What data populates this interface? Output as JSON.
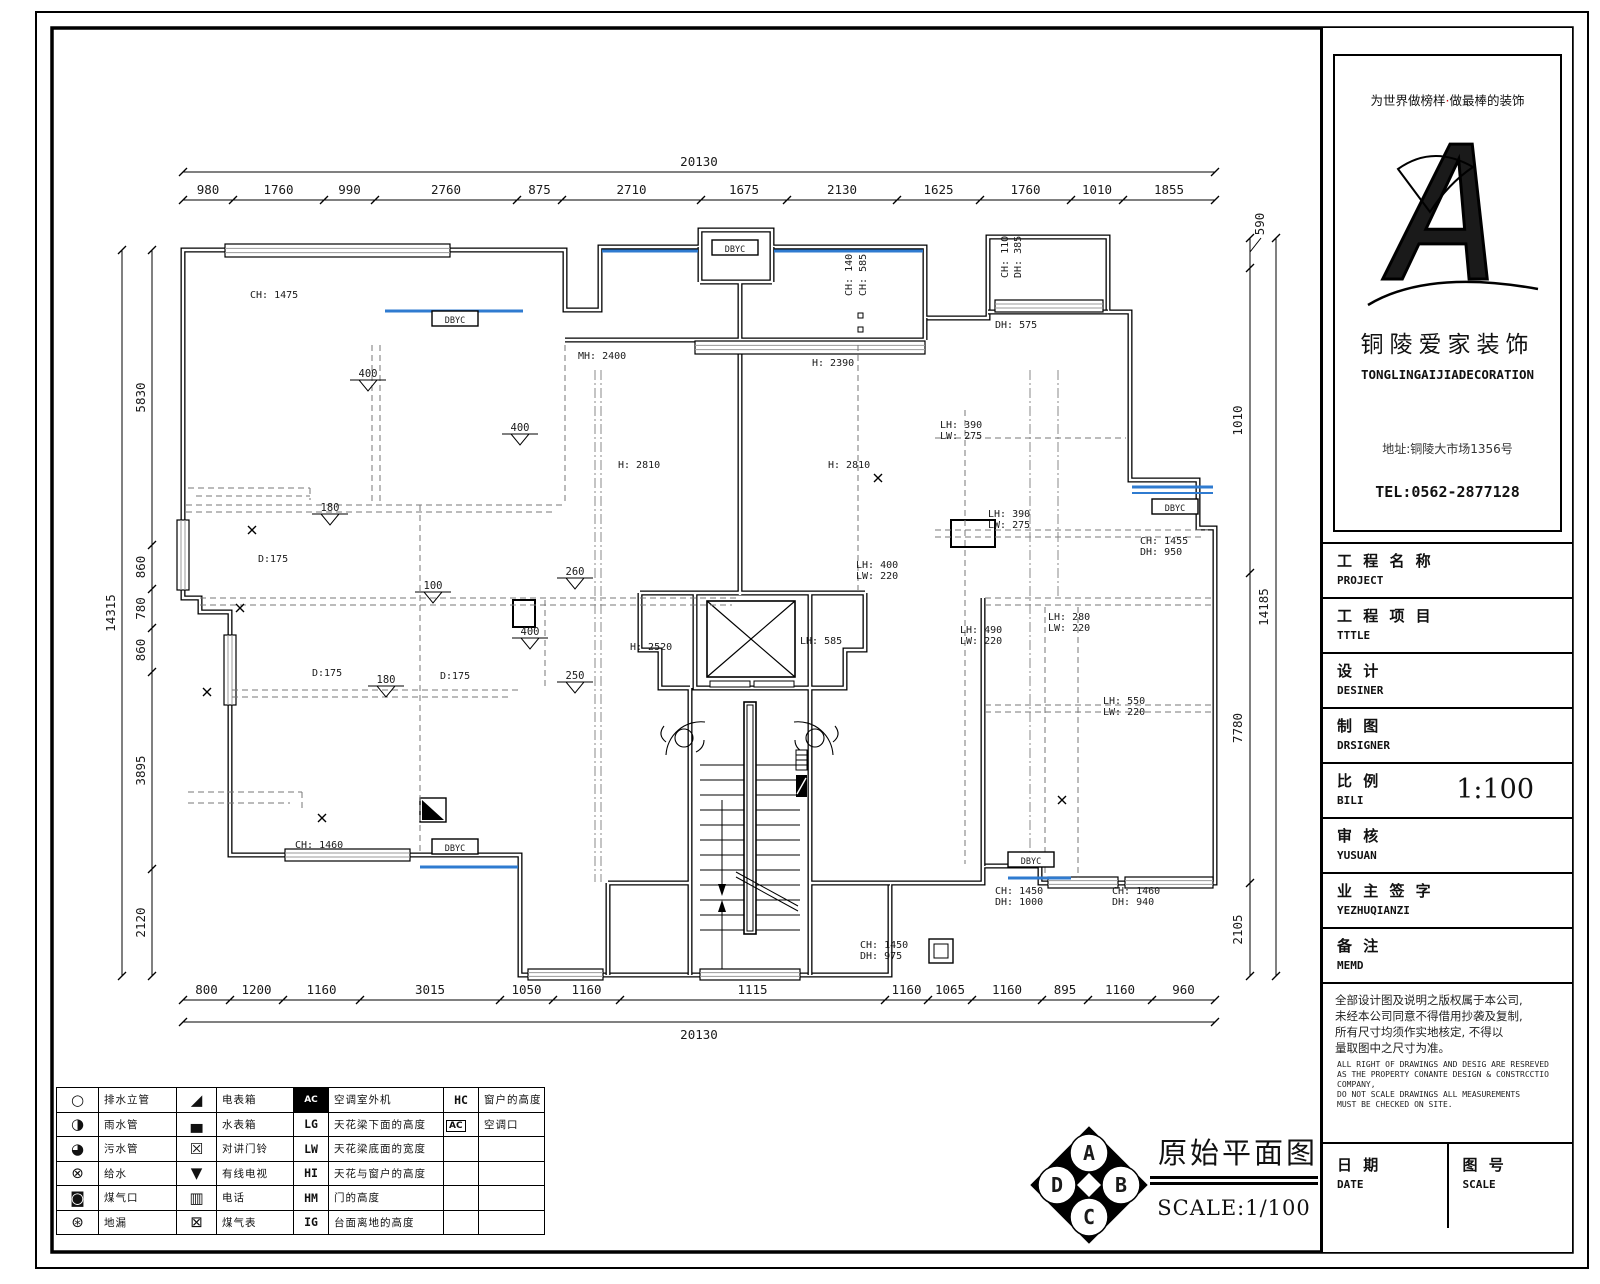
{
  "brand": {
    "slogan_a": "为世界做榜样",
    "slogan_dot": "·",
    "slogan_b": "做最棒的装饰",
    "name_cn": "铜陵爱家装饰",
    "name_en": "TONGLINGAIJIADECORATION",
    "address": "地址:铜陵大市场1356号",
    "tel": "TEL:0562-2877128"
  },
  "titleblock": {
    "rows": [
      {
        "cn": "工 程 名 称",
        "en": "PROJECT",
        "value": ""
      },
      {
        "cn": "工 程 项 目",
        "en": "TTTLE",
        "value": ""
      },
      {
        "cn": "设   计",
        "en": "DESINER",
        "value": ""
      },
      {
        "cn": "制   图",
        "en": "DRSIGNER",
        "value": ""
      },
      {
        "cn": "比   例",
        "en": "BILI",
        "value": "1:100"
      },
      {
        "cn": "审   核",
        "en": "YUSUAN",
        "value": ""
      },
      {
        "cn": "业 主 签 字",
        "en": "YEZHUQIANZI",
        "value": ""
      },
      {
        "cn": "备   注",
        "en": "MEMD",
        "value": ""
      }
    ],
    "notes_cn": [
      "全部设计图及说明之版权属于本公司,",
      "未经本公司同意不得借用抄袭及复制,",
      "所有尺寸均须作实地核定, 不得以",
      "量取图中之尺寸为准。"
    ],
    "notes_en": [
      "ALL RIGHT OF DRAWINGS AND DESIG ARE RESREVED",
      "AS THE PROPERTY CONANTE DESIGN & CONSTRCCTIO",
      "COMPANY,",
      "DO NOT SCALE DRAWINGS ALL MEASUREMENTS",
      "MUST BE CHECKED ON SITE."
    ],
    "date_cn": "日 期",
    "date_en": "DATE",
    "sheet_cn": "图 号",
    "sheet_en": "SCALE"
  },
  "footer": {
    "title": "原始平面图",
    "scale": "SCALE:1/100",
    "compass": [
      "A",
      "B",
      "C",
      "D"
    ]
  },
  "legend": {
    "rows": [
      [
        "○",
        "排水立管",
        "◢",
        "电表箱",
        "!AC",
        "空调室外机",
        "HC",
        "窗户的高度"
      ],
      [
        "◑",
        "雨水管",
        "▄",
        "水表箱",
        "LG",
        "天花梁下面的高度",
        "[AC]",
        "空调口"
      ],
      [
        "◕",
        "污水管",
        "☒",
        "对讲门铃",
        "LW",
        "天花梁底面的宽度",
        "",
        ""
      ],
      [
        "⊗",
        "给水",
        "▼",
        "有线电视",
        "HI",
        "天花与窗户的高度",
        "",
        ""
      ],
      [
        "◙",
        "煤气口",
        "▥",
        "电话",
        "HM",
        "门的高度",
        "",
        ""
      ],
      [
        "⊛",
        "地漏",
        "⊠",
        "煤气表",
        "IG",
        "台面离地的高度",
        "",
        ""
      ]
    ]
  },
  "dims": {
    "top_total": "20130",
    "bottom_total": "20130",
    "left_total": "14315",
    "right_total": "14185",
    "top": [
      "980",
      "1760",
      "990",
      "2760",
      "875",
      "2710",
      "1675",
      "2130",
      "1625",
      "1760",
      "1010",
      "1855"
    ],
    "bottom": [
      "800",
      "1200",
      "1160",
      "3015",
      "1050",
      "1160",
      "1115",
      "1160",
      "1065",
      "1160",
      "895",
      "1160",
      "960"
    ],
    "left": [
      "5830",
      "860",
      "780",
      "860",
      "3895",
      "2120"
    ],
    "right": [
      "590",
      "1010",
      "7780",
      "2105"
    ]
  },
  "plan": {
    "window_tag": "DBYC",
    "labels": {
      "ch1475": "CH: 1475",
      "mh2400": "MH: 2400",
      "h2390": "H: 2390",
      "h2810": "H: 2810",
      "dh575": "DH: 575",
      "d175": "D:175",
      "h2520": "H: 2520",
      "lh585": "LH: 585",
      "ch140": "CH: 140",
      "ch585": "CH: 585",
      "ch110": "CH: 110",
      "dh385": "DH: 385",
      "ch1460": "CH: 1460"
    },
    "beams": [
      {
        "h": "LH: 390",
        "w": "LW: 275"
      },
      {
        "h": "LH: 390",
        "w": "LW: 275"
      },
      {
        "h": "LH: 400",
        "w": "LW: 220"
      },
      {
        "h": "LH: 490",
        "w": "LW: 220"
      },
      {
        "h": "LH: 280",
        "w": "LW: 220"
      },
      {
        "h": "LH: 550",
        "w": "LW: 220"
      }
    ],
    "windows": [
      {
        "c": "CH: 1455",
        "d": "DH: 950"
      },
      {
        "c": "CH: 1450",
        "d": "DH: 1000"
      },
      {
        "c": "CH: 1460",
        "d": "DH: 940"
      },
      {
        "c": "CH: 1450",
        "d": "DH: 975"
      }
    ],
    "levels": [
      "400",
      "400",
      "180",
      "100",
      "400",
      "260",
      "250",
      "180"
    ],
    "colors": {
      "window_blue": "#2f7bd0",
      "dash_gray": "#777777",
      "hatch_gray": "#999999"
    }
  }
}
